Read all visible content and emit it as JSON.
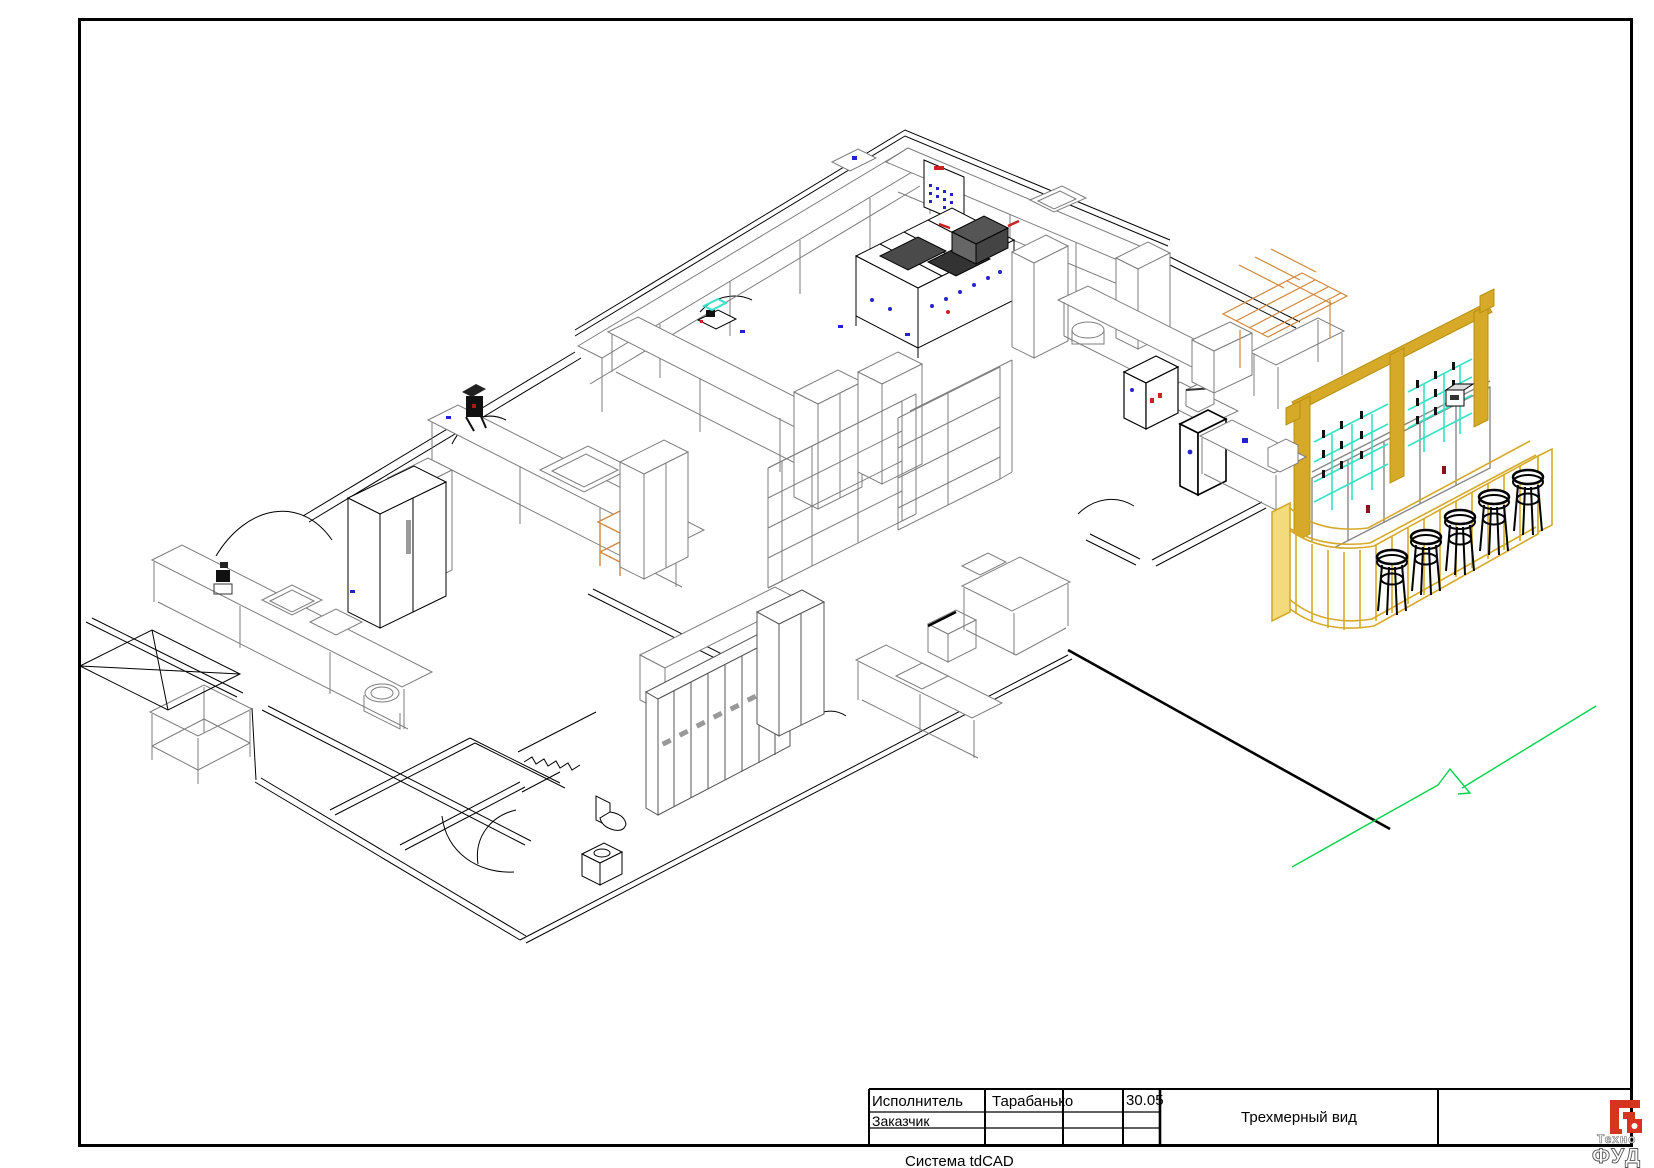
{
  "title_block": {
    "executor_label": "Исполнитель",
    "executor_value": "Тарабанько",
    "date": "30.05",
    "customer_label": "Заказчик",
    "drawing_title": "Трехмерный вид",
    "system_caption": "Система tdCAD"
  },
  "logo": {
    "line1": "Техно",
    "line2": "ФУД"
  },
  "drawing": {
    "view_type": "Трехмерный вид",
    "counts": {
      "bar_stools": 5,
      "lockers": 8
    },
    "colors": {
      "line_black": "#000000",
      "line_gray": "#7d7d7d",
      "bar_yellow": "#d6a928",
      "bar_yellow_dark": "#b8900f",
      "glass_cyan": "#36e2c6",
      "lattice_orange": "#d2873a",
      "section_green": "#00d44a",
      "accent_blue": "#2323cc",
      "accent_red": "#cc2222",
      "logo_red": "#d43420"
    }
  }
}
